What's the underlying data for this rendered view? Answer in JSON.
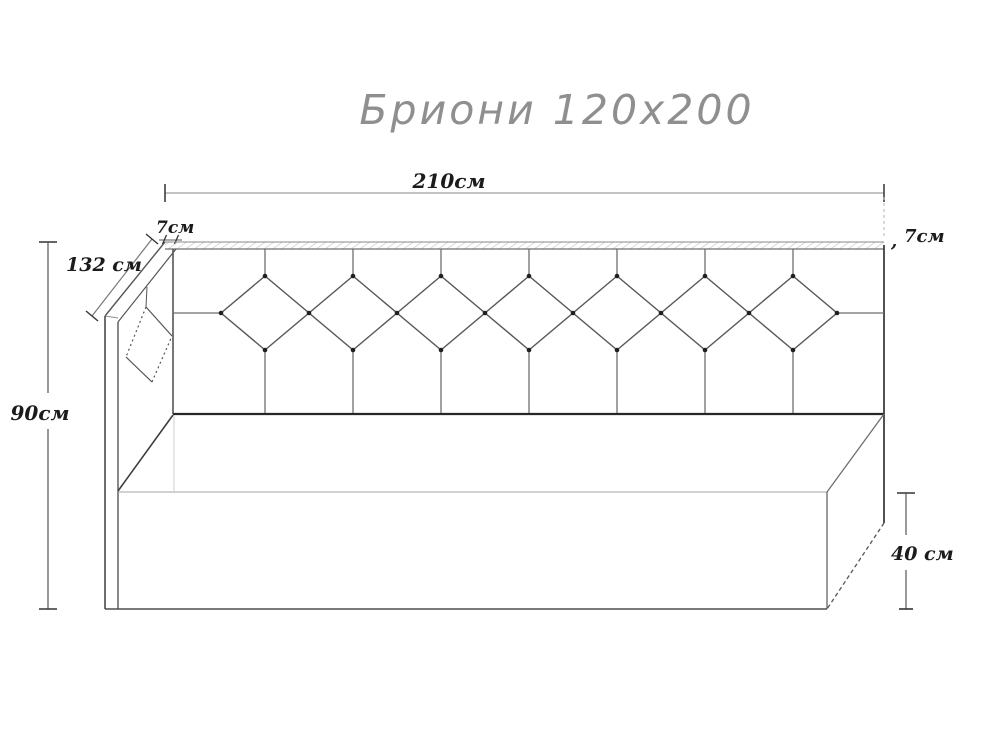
{
  "title": "Бриони 120x200",
  "drawing": {
    "type": "technical line sketch",
    "object": "bed with diamond-tufted headboard and corner side panel",
    "headboard_diamond_count": 7
  },
  "dimensions": {
    "top_width": "210см",
    "left_thickness": "7см",
    "depth": "132 см",
    "total_height": "90см",
    "base_height": "40 см",
    "right_thickness": "7см",
    "right_thickness_leader": ","
  },
  "colors": {
    "background": "#ffffff",
    "line": "#5f5f5f",
    "dark_line": "#2a2a2a",
    "dimension_line": "#8a8a8a",
    "dimension_text": "#1b1b1b",
    "title_text": "#8f8f8f"
  }
}
